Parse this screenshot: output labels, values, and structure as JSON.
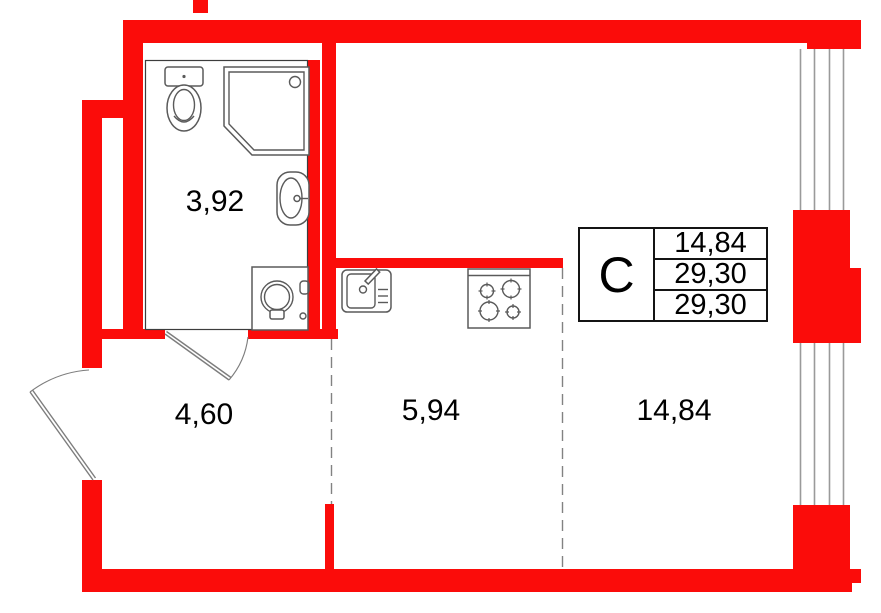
{
  "plan": {
    "rooms": {
      "bathroom": "3,92",
      "hallway": "4,60",
      "kitchen": "5,94",
      "living_room": "14,84"
    },
    "info_table": {
      "type_label": "C",
      "rows": [
        "14,84",
        "29,30",
        "29,30"
      ]
    },
    "fixtures": [
      "toilet",
      "shower-cabin",
      "wash-basin",
      "washing-machine",
      "kitchen-sink",
      "cooktop"
    ],
    "colors": {
      "wall_red": "#fb0c0a",
      "fixture_gray": "#5a5a5a",
      "dash_gray": "#828282",
      "window_gray": "#9a9a9a",
      "door_gray": "#7d7d7d",
      "text_black": "#000000"
    }
  }
}
